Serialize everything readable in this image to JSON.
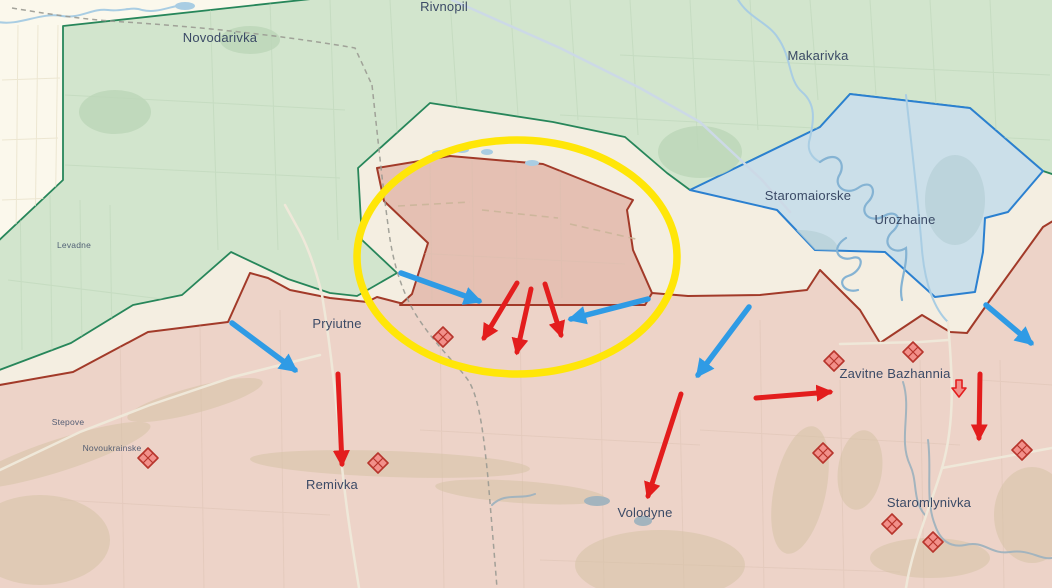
{
  "map": {
    "towns": [
      {
        "id": "novodarivka",
        "name": "Novodarivka",
        "x": 220,
        "y": 42,
        "size": "large"
      },
      {
        "id": "rivnopil",
        "name": "Rivnopil",
        "x": 444,
        "y": 11,
        "size": "large"
      },
      {
        "id": "makarivka",
        "name": "Makarivka",
        "x": 818,
        "y": 60,
        "size": "large"
      },
      {
        "id": "staromaiorske",
        "name": "Staromaiorske",
        "x": 808,
        "y": 200,
        "size": "large"
      },
      {
        "id": "urozhaine",
        "name": "Urozhaine",
        "x": 905,
        "y": 224,
        "size": "large"
      },
      {
        "id": "pryiutne",
        "name": "Pryiutne",
        "x": 337,
        "y": 328,
        "size": "large"
      },
      {
        "id": "levadne",
        "name": "Levadne",
        "x": 74,
        "y": 248,
        "size": "small"
      },
      {
        "id": "stepove",
        "name": "Stepove",
        "x": 68,
        "y": 425,
        "size": "small"
      },
      {
        "id": "novoukrainske",
        "name": "Novoukrainske",
        "x": 112,
        "y": 451,
        "size": "small"
      },
      {
        "id": "remivka",
        "name": "Remivka",
        "x": 332,
        "y": 489,
        "size": "large"
      },
      {
        "id": "volodyne",
        "name": "Volodyne",
        "x": 645,
        "y": 517,
        "size": "large"
      },
      {
        "id": "zavitne-bazhannia",
        "name": "Zavitne Bazhannia",
        "x": 895,
        "y": 378,
        "size": "large"
      },
      {
        "id": "staromlynivka",
        "name": "Staromlynivka",
        "x": 929,
        "y": 507,
        "size": "large"
      }
    ],
    "arrows": {
      "attack": [
        [
          517,
          283,
          484,
          338
        ],
        [
          531,
          289,
          517,
          352
        ],
        [
          545,
          284,
          561,
          335
        ],
        [
          338,
          374,
          342,
          464
        ],
        [
          681,
          394,
          648,
          496
        ],
        [
          756,
          398,
          830,
          392
        ],
        [
          980,
          374,
          979,
          438
        ]
      ],
      "counter": [
        [
          232,
          323,
          295,
          370
        ],
        [
          401,
          273,
          479,
          301
        ],
        [
          648,
          299,
          571,
          319
        ],
        [
          749,
          307,
          698,
          375
        ],
        [
          986,
          305,
          1031,
          343
        ]
      ]
    },
    "fortifications": [
      [
        443,
        337
      ],
      [
        148,
        458
      ],
      [
        378,
        463
      ],
      [
        834,
        361
      ],
      [
        823,
        453
      ],
      [
        913,
        352
      ],
      [
        1022,
        450
      ],
      [
        892,
        524
      ],
      [
        933,
        542
      ]
    ],
    "retreat_icon": {
      "x": 959,
      "y": 388
    },
    "highlight": {
      "cx": 517,
      "cy": 257,
      "rx": 160,
      "ry": 117
    },
    "colors": {
      "background": "#f4eee1",
      "free_area": "#fbf8ec",
      "liberated_fill": "#d2e5cd",
      "liberated_border": "#27865a",
      "contested_fill": "#cbdfe9",
      "contested_border": "#2b80d0",
      "occupied_fill": "#edd3c8",
      "occupied_border": "#a23a29",
      "advance_fill": "#e5c0b3",
      "highlight": "#ffe608",
      "attack_arrow": "#e31d1d",
      "counter_arrow": "#2f9be5",
      "fort_fill": "#f2908a",
      "fort_border": "#b7352c",
      "label": "#3b4a66",
      "river": "#a9cde3",
      "river_dark": "#85b3d3",
      "stream_gray": "#a3b4be",
      "road": "#efe8d9",
      "road_blue": "#ccd9e6",
      "track_tan": "#c9b498",
      "field_green": "#b9d3b6",
      "field_red": "#d9bfae",
      "field_white": "#e9e2cb",
      "patch_green": "#bcd6b8",
      "patch_blue": "#b5ced6",
      "forest_tan": "#d5c3a6",
      "boundary_dash": "#9a9a92"
    }
  }
}
